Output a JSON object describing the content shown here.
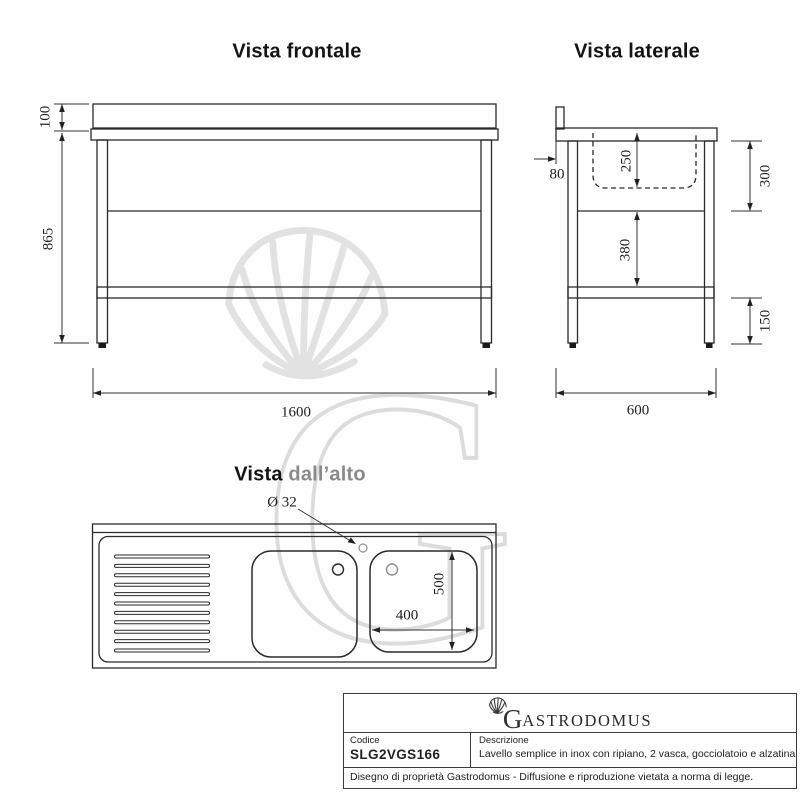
{
  "titles": {
    "front_view": "Vista frontale",
    "side_view": "Vista laterale",
    "top_view_word1": "Vista ",
    "top_view_word2": "dall’alto"
  },
  "dimensions": {
    "front": {
      "backsplash_height": "100",
      "body_height": "865",
      "length": "1600"
    },
    "side": {
      "back_offset": "80",
      "basin_depth": "250",
      "top_section_height": "300",
      "mid_section_height": "380",
      "shelf_clearance": "150",
      "depth": "600"
    },
    "top": {
      "drain_hole_diameter": "Ø 32",
      "basin_width": "400",
      "basin_length": "500"
    }
  },
  "title_block": {
    "logo_g": "G",
    "logo_rest": "ASTRODOMUS",
    "code_label": "Codice",
    "code_value": "SLG2VGS166",
    "description_label": "Descrizione",
    "description_value": "Lavello semplice in inox con ripiano, 2 vasca, gocciolatoio e alzatina",
    "footer": "Disegno di proprietà Gastrodomus - Diffusione e riproduzione vietata a norma di legge."
  },
  "colors": {
    "line": "#2a2a2a",
    "dim_line": "#333333",
    "gray_text": "#8a8a8a",
    "watermark": "#e2e2e2"
  }
}
